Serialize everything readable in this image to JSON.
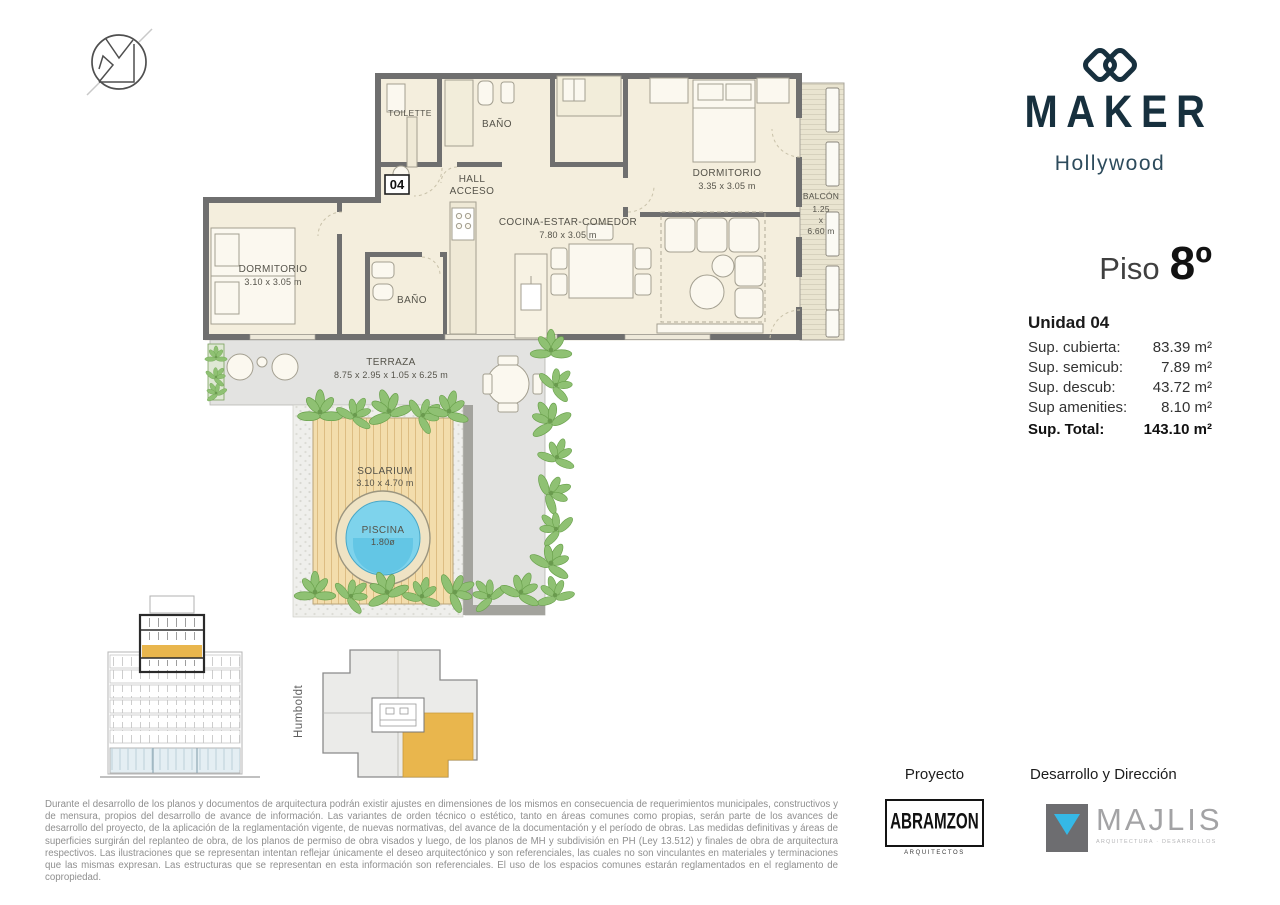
{
  "brand": {
    "name": "MAKER",
    "sub": "Hollywood"
  },
  "floor": {
    "label": "Piso",
    "number": "8º"
  },
  "unit": {
    "title": "Unidad 04",
    "rows": [
      {
        "label": "Sup. cubierta:",
        "value": "83.39 m²"
      },
      {
        "label": "Sup. semicub:",
        "value": "7.89 m²"
      },
      {
        "label": "Sup. descub:",
        "value": "43.72 m²"
      },
      {
        "label": "Sup amenities:",
        "value": "8.10 m²"
      }
    ],
    "total_label": "Sup. Total:",
    "total_value": "143.10 m²"
  },
  "plan": {
    "unit_badge": "04",
    "labels": {
      "toilette": "TOILETTE",
      "bano1": "BAÑO",
      "hall1": "HALL",
      "hall2": "ACCESO",
      "dorm1": "DORMITORIO",
      "dorm1_dim": "3.35 x 3.05 m",
      "balcon": "BALCÓN",
      "balcon_d1": "1.25",
      "balcon_d2": "x",
      "balcon_d3": "6.60 m",
      "dorm2": "DORMITORIO",
      "dorm2_dim": "3.10 x 3.05 m",
      "bano2": "BAÑO",
      "cocina": "COCINA-ESTAR-COMEDOR",
      "cocina_dim": "7.80 x 3.05 m",
      "terraza": "TERRAZA",
      "terraza_dim": "8.75 x 2.95 x 1.05 x 6.25 m",
      "solarium": "SOLARIUM",
      "solarium_dim": "3.10 x 4.70 m",
      "piscina": "PISCINA",
      "piscina_dim": "1.80ø"
    }
  },
  "keyplan": {
    "street": "Humboldt"
  },
  "credits": {
    "proyecto_label": "Proyecto",
    "proyecto_name": "ABRAMZON",
    "proyecto_sub": "ARQUITECTOS",
    "direccion_label": "Desarrollo y Dirección",
    "direccion_name": "MAJLIS",
    "direccion_sub": "ARQUITECTURA · DESARROLLOS"
  },
  "colors": {
    "brand_navy": "#17303e",
    "highlight_orange": "#e9b64d",
    "pool_blue": "#7ed3ec",
    "plant_green": "#8fc173",
    "wall_gray": "#6f6f6f",
    "floor_cream": "#f4eedd",
    "majlis_cyan": "#35b8e6"
  },
  "disclaimer": "Durante el desarrollo de los planos y documentos de arquitectura podrán existir ajustes en dimensiones de los mismos en consecuencia de requerimientos municipales, constructivos y de mensura, propios del desarrollo de avance de información. Las variantes de orden técnico o estético, tanto en áreas comunes como propias, serán parte de los avances de desarrollo del proyecto, de la aplicación de la reglamentación vigente, de nuevas normativas, del avance de la documentación y el período de obras. Las medidas definitivas y áreas de superficies surgirán del replanteo de obra, de los planos de permiso de obra visados y luego, de los planos de MH y subdivisión en PH (Ley 13.512) y finales de obra de arquitectura respectivos. Las ilustraciones que se representan intentan reflejar únicamente el deseo arquitectónico y son referenciales, las cuales no son vinculantes en materiales y terminaciones que las mismas expresan. Las estructuras que se representan en esta información son referenciales. El uso de los espacios comunes estarán reglamentados en el reglamento de copropiedad."
}
